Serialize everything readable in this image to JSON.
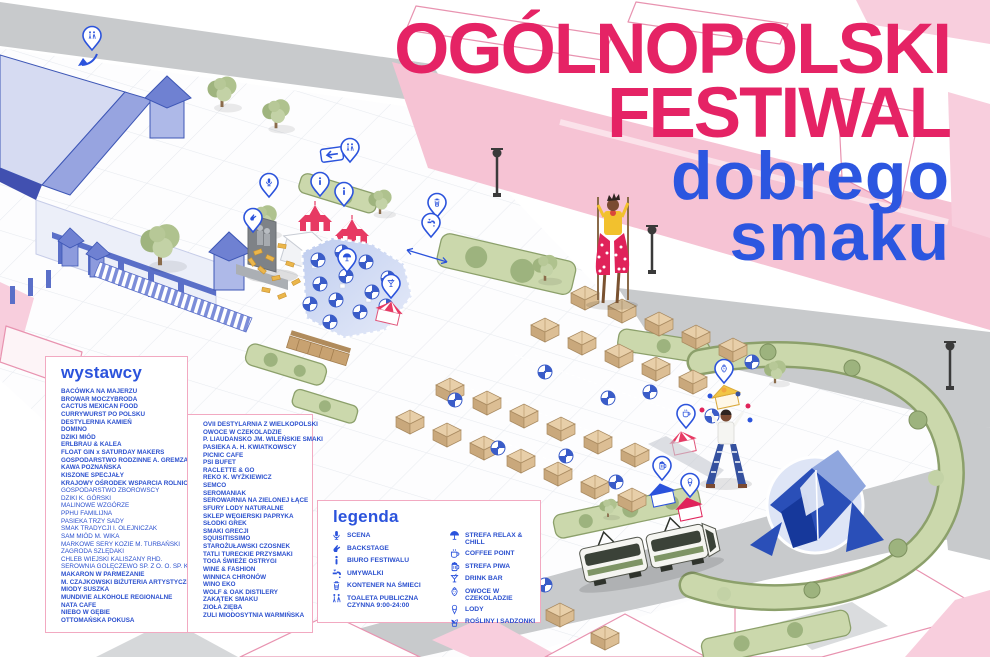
{
  "title": {
    "line1": "OGÓLNOPOLSKI",
    "line2": "FESTIWAL",
    "line3": "dobrego",
    "line4": "smaku"
  },
  "colors": {
    "pink": "#E52365",
    "blue": "#2C56E0",
    "list_blue": "#2B50CE"
  },
  "exhibitors": {
    "heading": "wystawcy",
    "column1": [
      "BACÓWKA NA MAJERZU",
      "BROWAR MOCZYBRODA",
      "CACTUS MEXICAN FOOD",
      "CURRYWURST PO POLSKU",
      "DESTYLERNIA KAMIEŃ",
      "DOMINO",
      "DZIKI MIÓD",
      "ERLBRAU & KALEA",
      "FLOAT GIN x SATURDAY MAKERS",
      "GOSPODARSTWO RODZINNE A. GREMZA",
      "KAWA POZNAŃSKA",
      "KISZONE SPECJAŁY",
      "KRAJOWY OŚRODEK WSPARCIA ROLNICTWA:",
      {
        "label": "GOSPODARSTWO ZBOROWSCY",
        "sub": true
      },
      {
        "label": "DZIKI K. GÓRSKI",
        "sub": true
      },
      {
        "label": "MALINOWE WZGÓRZE",
        "sub": true
      },
      {
        "label": "PPHU FAMILIJNA",
        "sub": true
      },
      {
        "label": "PASIEKA TRZY SADY",
        "sub": true
      },
      {
        "label": "SMAK TRADYCJI I. OLEJNICZAK",
        "sub": true
      },
      {
        "label": "SAM MIÓD M. WIKA",
        "sub": true
      },
      {
        "label": "MARKOWE SERY KOZIE M. TURBAŃSKI",
        "sub": true
      },
      {
        "label": "ZAGRODA SZLĘDAKI",
        "sub": true
      },
      {
        "label": "CHLEB WIEJSKI KALISZANY RHD.",
        "sub": true
      },
      {
        "label": "SEROWNIA GOLĘCZEWO SP. Z O. O. SP. K.",
        "sub": true
      },
      "MAKARON W PARMEZANIE",
      "M. CZAJKOWSKI BIŻUTERIA ARTYSTYCZNA",
      "MIODY SUSZKA",
      "MUNDIVIE ALKOHOLE REGIONALNE",
      "NATA CAFE",
      "NIEBO W GĘBIE",
      "OTTOMAŃSKA POKUSA"
    ],
    "column2": [
      "OVII DESTYLARNIA Z WIELKOPOLSKI",
      "OWOCE W CZEKOLADZIE",
      "P. LIAUDANSKO JM. WILEŃSKIE SMAKI",
      "PASIEKA A. H. KWIATKOWSCY",
      "PICNIC CAFE",
      "PSI BUFET",
      "RACLETTE & GO",
      "REKO K. WYŻKIEWICZ",
      "SEMCO",
      "SEROMANIAK",
      "SEROWARNIA NA ZIELONEJ ŁĄCE",
      "SFURY LODY NATURALNE",
      "SKLEP WĘGIERSKI PAPRYKA",
      "SŁODKI GREK",
      "SMAKI GRECJI",
      "SQUISITISSIMO",
      "STAROŻUŁAWSKI CZOSNEK",
      "TATLI TURECKIE PRZYSMAKI",
      "TOGA ŚWIEŻE OSTRYGI",
      "WINE & FASHION",
      "WINNICA CHRONÓW",
      "WINO EKO",
      "WOLF & OAK DISTILERY",
      "ZAKĄTEK SMAKU",
      "ZIOŁA ZIĘBA",
      "ZULI MIODOSYTNIA WARMIŃSKA"
    ]
  },
  "legend": {
    "heading": "legenda",
    "column1": [
      {
        "icon": "microphone",
        "label": "SCENA"
      },
      {
        "icon": "backstage",
        "label": "BACKSTAGE"
      },
      {
        "icon": "info",
        "label": "BIURO FESTIWALU"
      },
      {
        "icon": "faucet",
        "label": "UMYWALKI"
      },
      {
        "icon": "trash",
        "label": "KONTENER NA ŚMIECI"
      },
      {
        "icon": "wc",
        "label": "TOALETA PUBLICZNA\nCZYNNA 9:00-24:00"
      }
    ],
    "column2": [
      {
        "icon": "parasol",
        "label": "STREFA RELAX & CHILL"
      },
      {
        "icon": "coffee",
        "label": "COFFEE POINT"
      },
      {
        "icon": "beer",
        "label": "STREFA PIWA"
      },
      {
        "icon": "drink",
        "label": "DRINK BAR"
      },
      {
        "icon": "strawberry",
        "label": "OWOCE W CZEKOLADZIE"
      },
      {
        "icon": "icecream",
        "label": "LODY"
      },
      {
        "icon": "plant",
        "label": "ROŚLINY I SADZONKI"
      }
    ]
  },
  "map": {
    "pin_icons": [
      "wc",
      "info",
      "microphone",
      "backstage",
      "parasol",
      "drink",
      "trash",
      "faucet",
      "strawberry",
      "coffee",
      "beer",
      "icecream"
    ]
  }
}
